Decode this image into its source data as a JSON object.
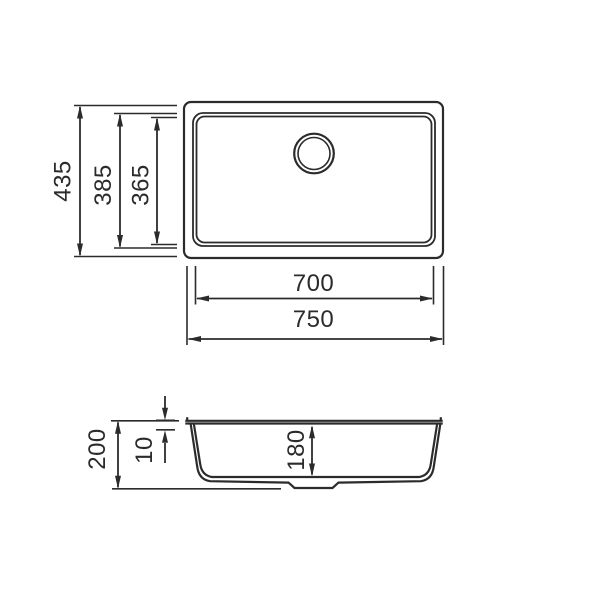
{
  "diagram": {
    "type": "technical-drawing-sink",
    "background": "#ffffff",
    "line_color": "#2b2b2b",
    "top_view": {
      "height_overall": "435",
      "height_rim": "385",
      "height_basin": "365",
      "width_rim": "700",
      "width_overall": "750"
    },
    "section_view": {
      "depth_overall": "200",
      "rim_thickness": "10",
      "depth_basin": "180"
    }
  }
}
